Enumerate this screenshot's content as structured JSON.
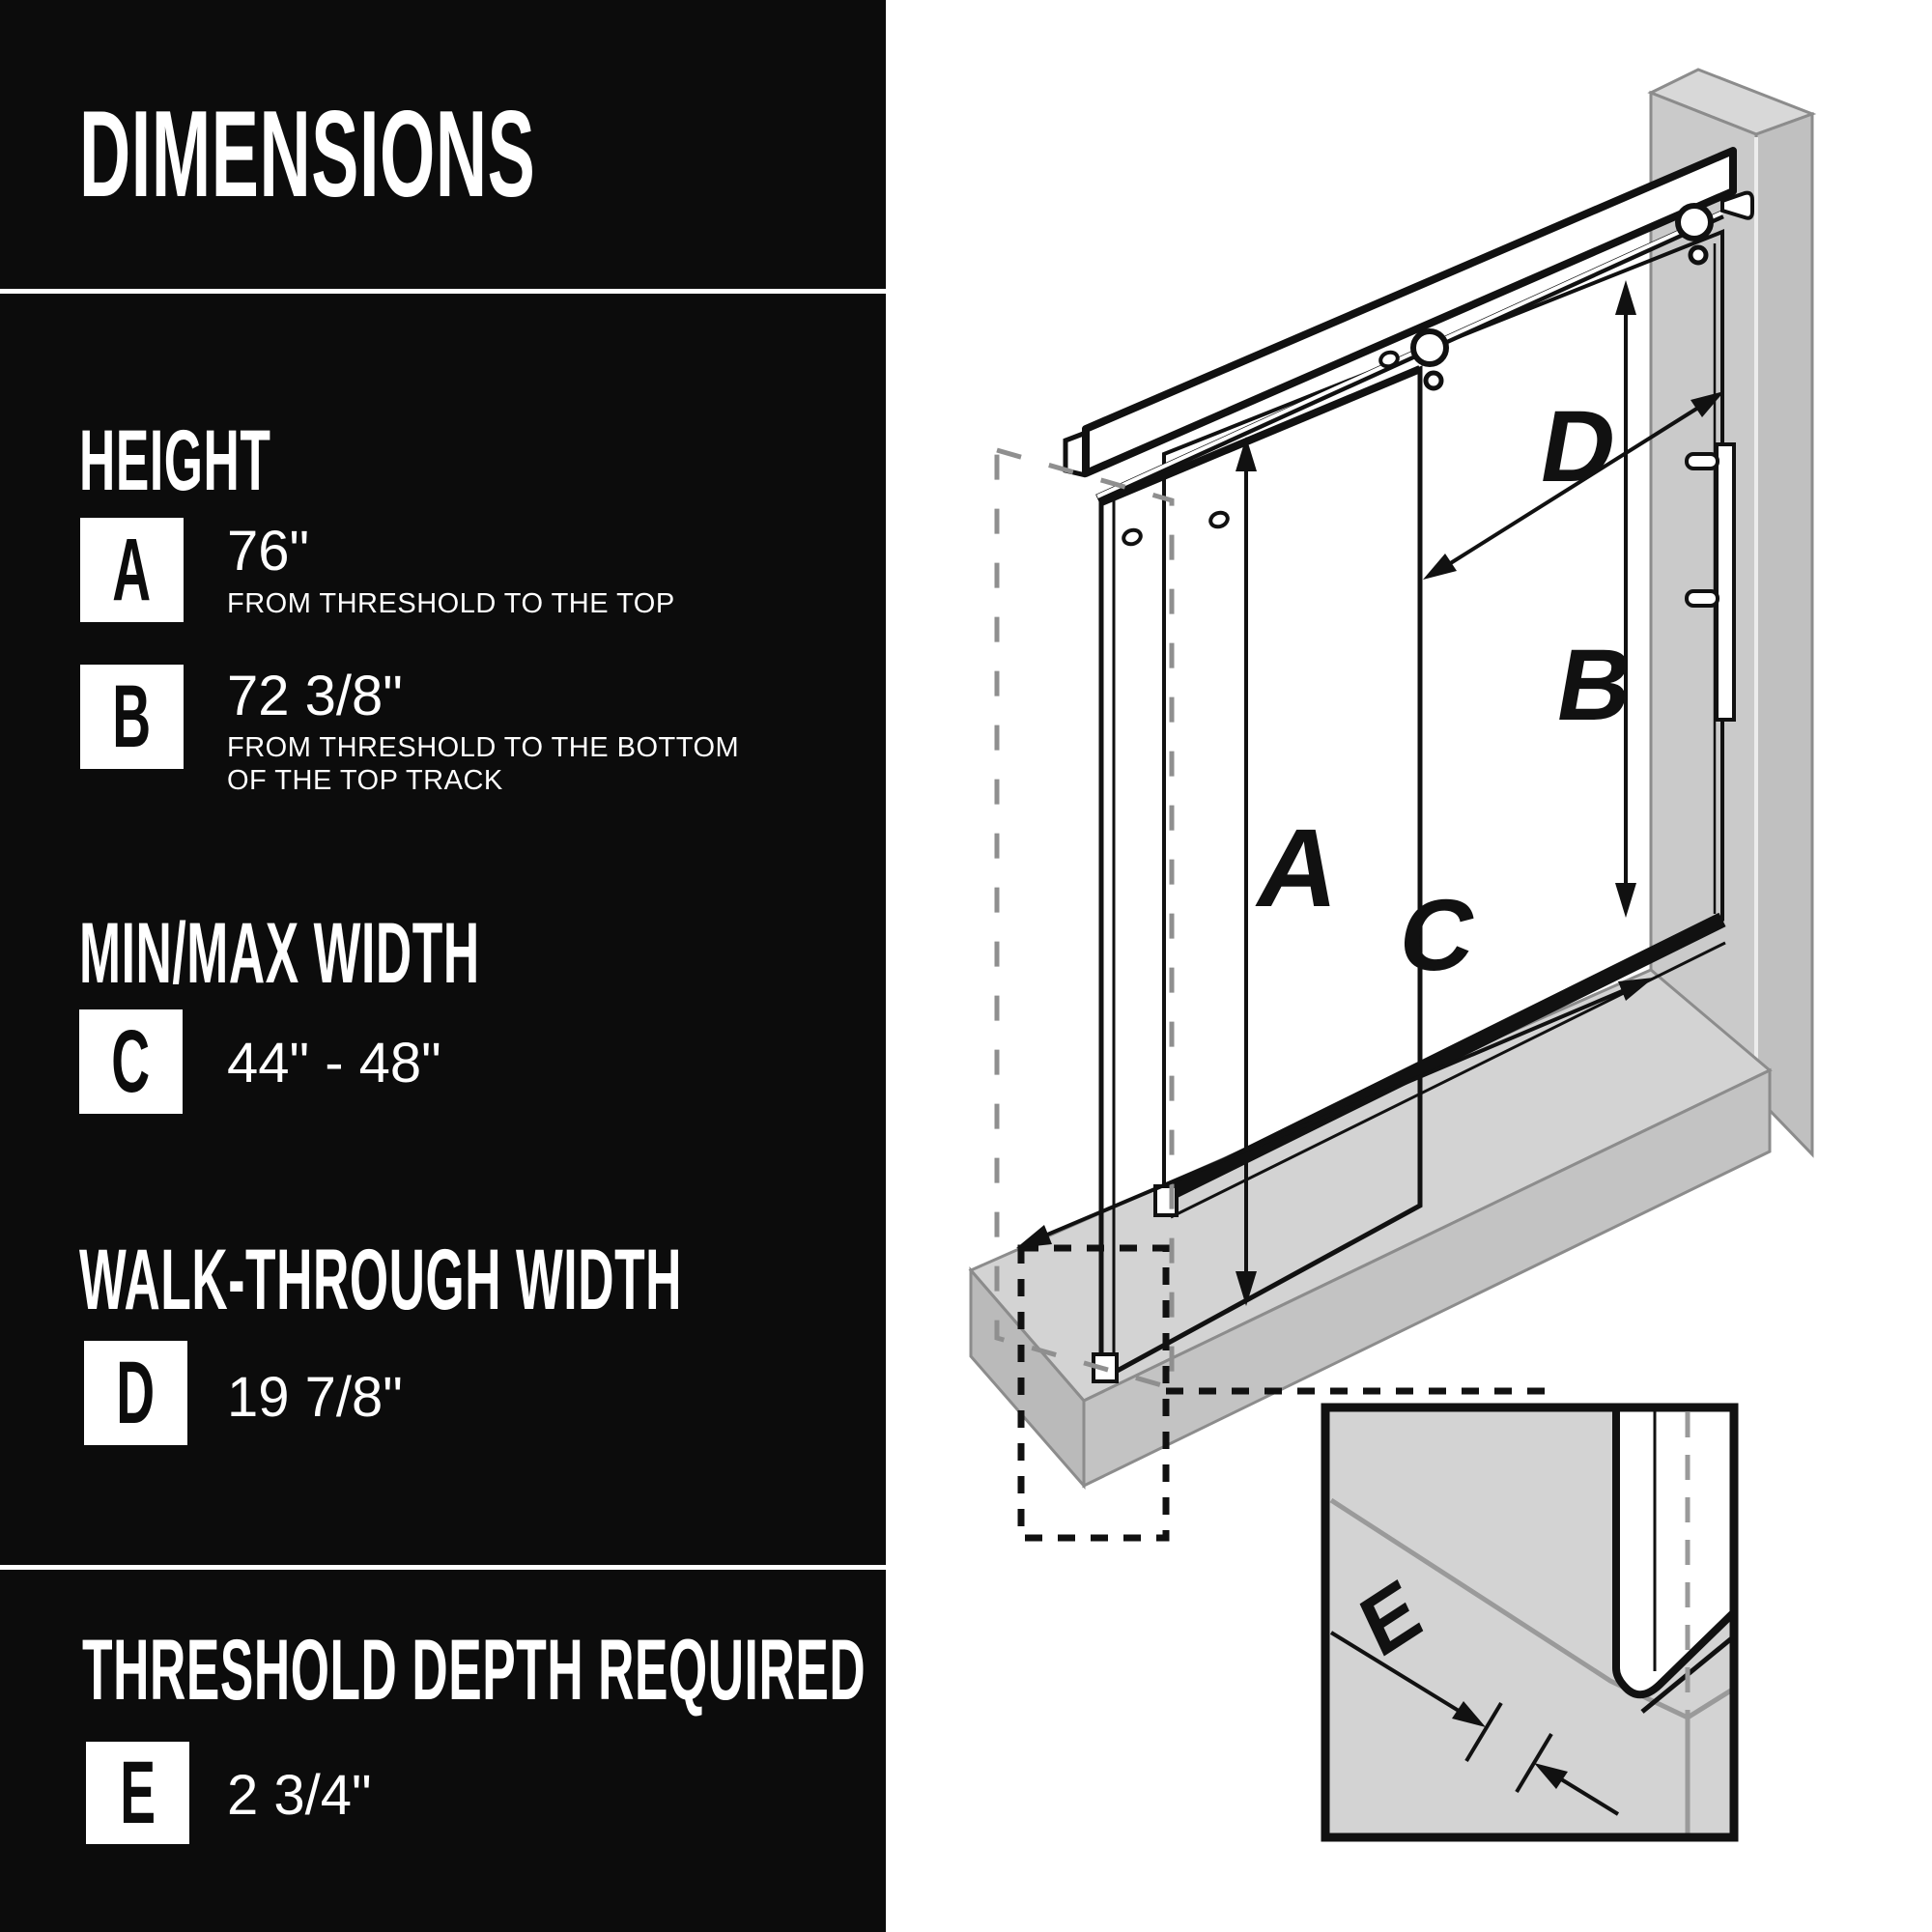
{
  "page": {
    "background": "#ffffff",
    "panel_background": "#0c0c0c",
    "text_color": "#ffffff",
    "line_color": "#111111",
    "wall_gray": "#cacaca",
    "threshold_gray": "#d3d3d3",
    "dashed_gray": "#8f8f8f"
  },
  "sidebar": {
    "title": "DIMENSIONS",
    "section_height": "HEIGHT",
    "section_minmax": "MIN/MAX WIDTH",
    "section_walkthrough": "WALK-THROUGH WIDTH",
    "section_threshold": "THRESHOLD DEPTH REQUIRED",
    "rows": {
      "a": {
        "letter": "A",
        "value": "76\"",
        "desc": "FROM THRESHOLD TO THE TOP"
      },
      "b": {
        "letter": "B",
        "value": "72 3/8\"",
        "desc1": "FROM THRESHOLD TO THE BOTTOM",
        "desc2": "OF THE TOP TRACK"
      },
      "c": {
        "letter": "C",
        "value": "44\" - 48\""
      },
      "d": {
        "letter": "D",
        "value": "19 7/8\""
      },
      "e": {
        "letter": "E",
        "value": "2 3/4\""
      }
    }
  },
  "diagram": {
    "type": "isometric-technical-drawing",
    "subject": "sliding glass shower door with wall, threshold and detail inset",
    "labels": {
      "a": "A",
      "b": "B",
      "c": "C",
      "d": "D",
      "e": "E"
    }
  }
}
